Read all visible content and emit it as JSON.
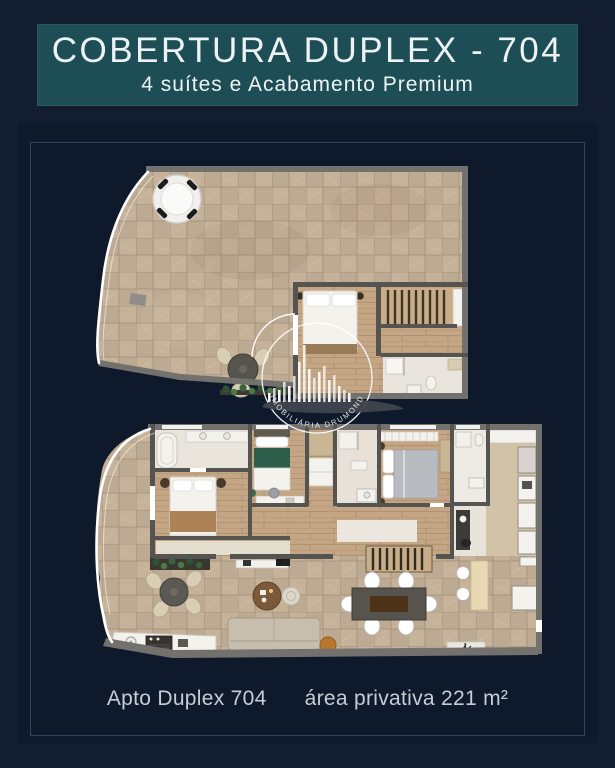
{
  "header": {
    "title": "COBERTURA DUPLEX - 704",
    "subtitle": "4 suítes e Acabamento Premium"
  },
  "watermark": {
    "brand": "IMOBILIÁRIA DRUMOND"
  },
  "footer": {
    "unit": "Apto Duplex 704",
    "area": "área privativa 221 m²"
  },
  "colors": {
    "page_bg": "#121e30",
    "panel_bg": "#0e1a2b",
    "panel_border": "#33435d",
    "header_bg": "#1d4e56",
    "header_text": "#edf3f4",
    "caption_text": "#c7ccd5",
    "watermark": "#f6f4ef",
    "wall": "#73716e",
    "wall_dark": "#565450",
    "floor_tile": "#c6b299",
    "floor_wood": "#c4a584",
    "floor_stone": "#d2c2a7",
    "floor_marble": "#e9e5dd",
    "furniture_white": "#f4f2ec",
    "railing": "#ffffff",
    "accent_green": "#3e6b47",
    "bed_green": "#2e5d4c",
    "bed_gray": "#b8bcc1",
    "sofa": "#c7beae",
    "wood_brown": "#7a5a3a",
    "counter": "#e7d9b4"
  }
}
